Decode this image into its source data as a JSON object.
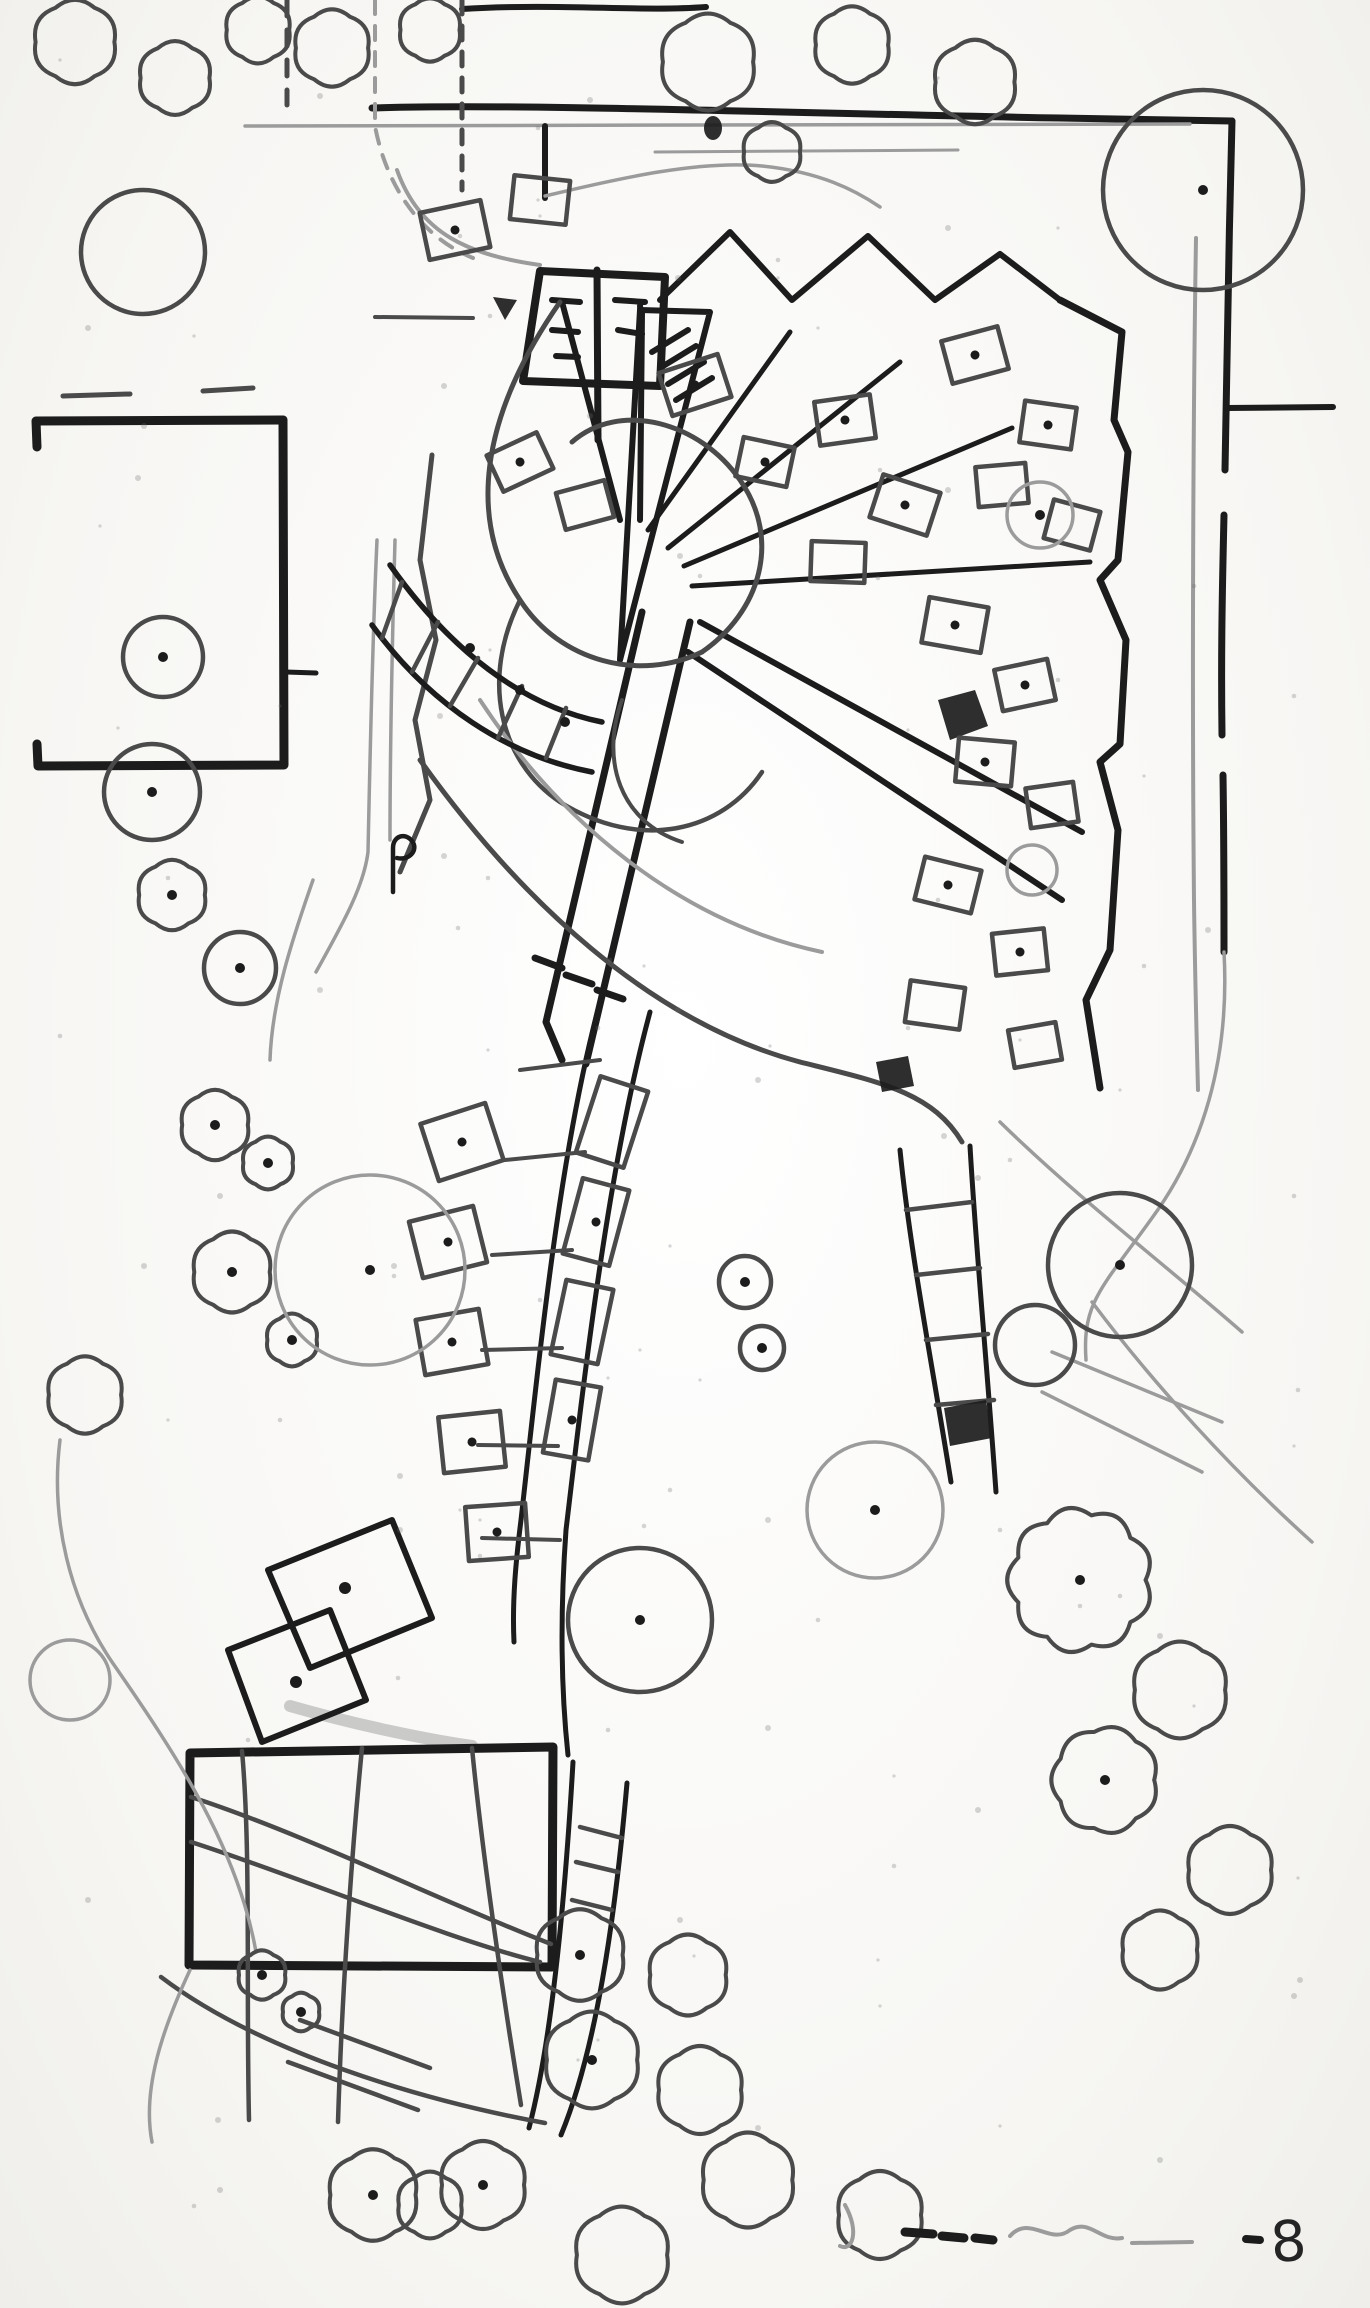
{
  "annotation": {
    "mark": "8"
  },
  "palette": {
    "ink": "#1c1c1c",
    "ink_medium": "#4a4a4a",
    "ink_light": "#9b9b9b",
    "paper": "#fbfbf9"
  },
  "trees": [
    {
      "x": 143,
      "y": 252,
      "r": 62,
      "style": "circle",
      "dot": false
    },
    {
      "x": 75,
      "y": 42,
      "r": 48,
      "style": "cloud",
      "dot": false
    },
    {
      "x": 175,
      "y": 78,
      "r": 42,
      "style": "cloud",
      "dot": false
    },
    {
      "x": 258,
      "y": 30,
      "r": 38,
      "style": "cloud",
      "dot": false
    },
    {
      "x": 332,
      "y": 48,
      "r": 44,
      "style": "cloud",
      "dot": false
    },
    {
      "x": 430,
      "y": 30,
      "r": 36,
      "style": "cloud",
      "dot": false
    },
    {
      "x": 708,
      "y": 62,
      "r": 55,
      "style": "cloud",
      "dot": false
    },
    {
      "x": 852,
      "y": 45,
      "r": 44,
      "style": "cloud",
      "dot": false
    },
    {
      "x": 975,
      "y": 82,
      "r": 48,
      "style": "cloud",
      "dot": false
    },
    {
      "x": 772,
      "y": 152,
      "r": 34,
      "style": "cloud",
      "dot": false
    },
    {
      "x": 1203,
      "y": 190,
      "r": 100,
      "style": "circle",
      "dot": true
    },
    {
      "x": 163,
      "y": 657,
      "r": 40,
      "style": "circle",
      "dot": true
    },
    {
      "x": 152,
      "y": 792,
      "r": 48,
      "style": "circle",
      "dot": true
    },
    {
      "x": 172,
      "y": 895,
      "r": 40,
      "style": "cloud",
      "dot": true
    },
    {
      "x": 240,
      "y": 968,
      "r": 36,
      "style": "circle",
      "dot": true
    },
    {
      "x": 215,
      "y": 1125,
      "r": 40,
      "style": "cloud",
      "dot": true
    },
    {
      "x": 268,
      "y": 1163,
      "r": 30,
      "style": "cloud",
      "dot": true
    },
    {
      "x": 232,
      "y": 1272,
      "r": 46,
      "style": "cloud",
      "dot": true
    },
    {
      "x": 292,
      "y": 1340,
      "r": 30,
      "style": "cloud",
      "dot": true
    },
    {
      "x": 370,
      "y": 1270,
      "r": 95,
      "style": "light",
      "dot": true
    },
    {
      "x": 85,
      "y": 1395,
      "r": 44,
      "style": "cloud",
      "dot": false
    },
    {
      "x": 70,
      "y": 1680,
      "r": 40,
      "style": "light",
      "dot": false
    },
    {
      "x": 640,
      "y": 1620,
      "r": 72,
      "style": "circle",
      "dot": true
    },
    {
      "x": 875,
      "y": 1510,
      "r": 68,
      "style": "light",
      "dot": true
    },
    {
      "x": 1120,
      "y": 1265,
      "r": 72,
      "style": "circle",
      "dot": true
    },
    {
      "x": 1035,
      "y": 1345,
      "r": 40,
      "style": "circle",
      "dot": false
    },
    {
      "x": 745,
      "y": 1282,
      "r": 26,
      "style": "circle",
      "dot": true
    },
    {
      "x": 762,
      "y": 1348,
      "r": 22,
      "style": "circle",
      "dot": true
    },
    {
      "x": 1080,
      "y": 1580,
      "r": 80,
      "style": "cloud",
      "dot": true
    },
    {
      "x": 1180,
      "y": 1690,
      "r": 55,
      "style": "cloud",
      "dot": false
    },
    {
      "x": 1105,
      "y": 1780,
      "r": 60,
      "style": "cloud",
      "dot": true
    },
    {
      "x": 1230,
      "y": 1870,
      "r": 50,
      "style": "cloud",
      "dot": false
    },
    {
      "x": 1160,
      "y": 1950,
      "r": 45,
      "style": "cloud",
      "dot": false
    },
    {
      "x": 262,
      "y": 1975,
      "r": 28,
      "style": "cloud",
      "dot": true
    },
    {
      "x": 301,
      "y": 2012,
      "r": 22,
      "style": "cloud",
      "dot": true
    },
    {
      "x": 373,
      "y": 2195,
      "r": 52,
      "style": "cloud",
      "dot": true
    },
    {
      "x": 430,
      "y": 2205,
      "r": 38,
      "style": "cloud",
      "dot": false
    },
    {
      "x": 483,
      "y": 2185,
      "r": 50,
      "style": "cloud",
      "dot": true
    },
    {
      "x": 580,
      "y": 1955,
      "r": 52,
      "style": "cloud",
      "dot": true
    },
    {
      "x": 592,
      "y": 2060,
      "r": 55,
      "style": "cloud",
      "dot": true
    },
    {
      "x": 688,
      "y": 1975,
      "r": 46,
      "style": "cloud",
      "dot": false
    },
    {
      "x": 700,
      "y": 2090,
      "r": 50,
      "style": "cloud",
      "dot": false
    },
    {
      "x": 748,
      "y": 2180,
      "r": 54,
      "style": "cloud",
      "dot": false
    },
    {
      "x": 622,
      "y": 2255,
      "r": 55,
      "style": "cloud",
      "dot": false
    },
    {
      "x": 880,
      "y": 2215,
      "r": 50,
      "style": "cloud",
      "dot": false
    },
    {
      "x": 1040,
      "y": 515,
      "r": 33,
      "style": "light",
      "dot": true
    },
    {
      "x": 1032,
      "y": 870,
      "r": 25,
      "style": "light",
      "dot": false
    }
  ]
}
